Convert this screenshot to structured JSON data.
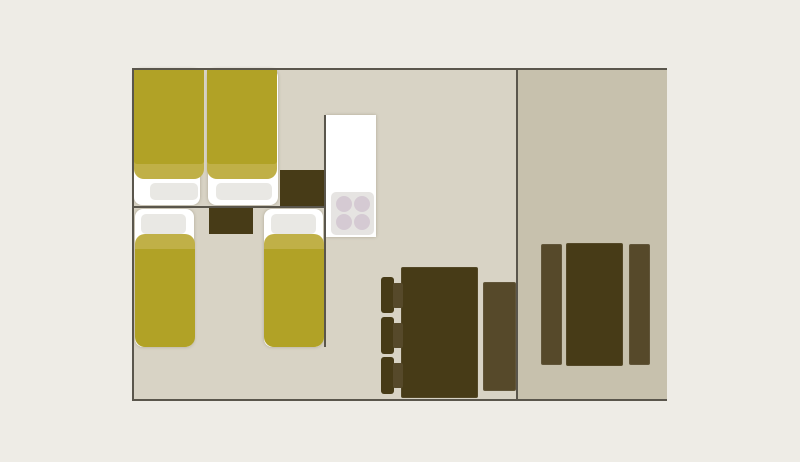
{
  "canvas": {
    "width": 800,
    "height": 462,
    "background": "#eeece6"
  },
  "palette": {
    "floor_left": "#d8d3c5",
    "floor_right": "#c7c1ad",
    "wall": "#5a564c",
    "duvet": "#b1a226",
    "duvet_band": "#c0b047",
    "mattress": "#ffffff",
    "pillow": "#e9e8e4",
    "wood_dark": "#473b17",
    "wood_mid": "#56492a",
    "counter": "#ffffff",
    "stove": "#e6e4e2",
    "burner": "#d5cad3"
  },
  "floorplan": {
    "description": "caravan-floor-plan",
    "rooms": [
      {
        "name": "left-section",
        "contains": [
          "double-bedroom",
          "twin-bedroom",
          "kitchen",
          "dining-area"
        ]
      },
      {
        "name": "right-section",
        "contains": [
          "terrace-dining"
        ]
      }
    ],
    "shapes": [
      {
        "name": "left-room-floor",
        "type": "rect",
        "x": 133,
        "y": 69,
        "w": 384,
        "h": 332,
        "fill": "floor_left"
      },
      {
        "name": "right-room-floor",
        "type": "rect",
        "x": 517,
        "y": 69,
        "w": 150,
        "h": 332,
        "fill": "floor_right"
      },
      {
        "name": "double-bed-mattress-left",
        "type": "rect",
        "x": 134,
        "y": 69,
        "w": 66,
        "h": 136,
        "fill": "mattress",
        "radius": "8px",
        "fx": "shadow"
      },
      {
        "name": "double-bed-mattress-right",
        "type": "rect",
        "x": 208,
        "y": 69,
        "w": 70,
        "h": 136,
        "fill": "mattress",
        "radius": "8px",
        "fx": "shadow"
      },
      {
        "name": "double-bed-pillow-left",
        "type": "rect",
        "x": 150,
        "y": 183,
        "w": 48,
        "h": 17,
        "fill": "pillow",
        "radius": "5px"
      },
      {
        "name": "double-bed-pillow-right",
        "type": "rect",
        "x": 216,
        "y": 183,
        "w": 56,
        "h": 17,
        "fill": "pillow",
        "radius": "5px"
      },
      {
        "name": "double-bed-duvet-band-left",
        "type": "rect",
        "x": 134,
        "y": 69,
        "w": 70,
        "h": 110,
        "fill": "duvet_band",
        "radius": "2px 2px 10px 10px"
      },
      {
        "name": "double-bed-duvet-band-right",
        "type": "rect",
        "x": 207,
        "y": 69,
        "w": 70,
        "h": 110,
        "fill": "duvet_band",
        "radius": "2px 2px 10px 10px"
      },
      {
        "name": "double-bed-duvet-left",
        "type": "rect",
        "x": 134,
        "y": 69,
        "w": 70,
        "h": 95,
        "fill": "duvet",
        "radius": "2px 2px 3px 3px"
      },
      {
        "name": "double-bed-duvet-right",
        "type": "rect",
        "x": 207,
        "y": 69,
        "w": 70,
        "h": 95,
        "fill": "duvet",
        "radius": "2px 2px 3px 3px"
      },
      {
        "name": "wardrobe",
        "type": "rect",
        "x": 280,
        "y": 170,
        "w": 45,
        "h": 37,
        "fill": "wood_dark"
      },
      {
        "name": "twin-nightstand",
        "type": "rect",
        "x": 209,
        "y": 208,
        "w": 44,
        "h": 26,
        "fill": "wood_dark"
      },
      {
        "name": "twin-bed-left-mattress",
        "type": "rect",
        "x": 135,
        "y": 209,
        "w": 59,
        "h": 138,
        "fill": "mattress",
        "radius": "8px",
        "fx": "shadow"
      },
      {
        "name": "twin-bed-left-pillow",
        "type": "rect",
        "x": 141,
        "y": 214,
        "w": 45,
        "h": 20,
        "fill": "pillow",
        "radius": "5px"
      },
      {
        "name": "twin-bed-left-duvet-band",
        "type": "rect",
        "x": 135,
        "y": 234,
        "w": 60,
        "h": 30,
        "fill": "duvet_band",
        "radius": "10px 10px 0 0"
      },
      {
        "name": "twin-bed-left-duvet",
        "type": "rect",
        "x": 135,
        "y": 249,
        "w": 60,
        "h": 98,
        "fill": "duvet",
        "radius": "0 0 10px 10px"
      },
      {
        "name": "twin-bed-right-mattress",
        "type": "rect",
        "x": 264,
        "y": 209,
        "w": 59,
        "h": 138,
        "fill": "mattress",
        "radius": "8px",
        "fx": "shadow"
      },
      {
        "name": "twin-bed-right-pillow",
        "type": "rect",
        "x": 271,
        "y": 214,
        "w": 45,
        "h": 20,
        "fill": "pillow",
        "radius": "5px"
      },
      {
        "name": "twin-bed-right-duvet-band",
        "type": "rect",
        "x": 264,
        "y": 234,
        "w": 60,
        "h": 30,
        "fill": "duvet_band",
        "radius": "10px 10px 0 0"
      },
      {
        "name": "twin-bed-right-duvet",
        "type": "rect",
        "x": 264,
        "y": 249,
        "w": 60,
        "h": 98,
        "fill": "duvet",
        "radius": "0 0 10px 10px"
      },
      {
        "name": "kitchen-counter",
        "type": "rect",
        "x": 326,
        "y": 115,
        "w": 50,
        "h": 122,
        "fill": "counter",
        "fx": "shadow"
      },
      {
        "name": "stove",
        "type": "rect",
        "x": 331,
        "y": 192,
        "w": 43,
        "h": 43,
        "fill": "stove",
        "radius": "5px"
      },
      {
        "name": "stove-burner-1",
        "type": "circle",
        "x": 336,
        "y": 196,
        "w": 16,
        "h": 16,
        "fill": "burner"
      },
      {
        "name": "stove-burner-2",
        "type": "circle",
        "x": 354,
        "y": 196,
        "w": 16,
        "h": 16,
        "fill": "burner"
      },
      {
        "name": "stove-burner-3",
        "type": "circle",
        "x": 336,
        "y": 214,
        "w": 16,
        "h": 16,
        "fill": "burner"
      },
      {
        "name": "stove-burner-4",
        "type": "circle",
        "x": 354,
        "y": 214,
        "w": 16,
        "h": 16,
        "fill": "burner"
      },
      {
        "name": "dining-table",
        "type": "rect",
        "x": 401,
        "y": 267,
        "w": 77,
        "h": 131,
        "fill": "wood_dark",
        "radius": "2px",
        "fx": "edge"
      },
      {
        "name": "dining-chair-1-back",
        "type": "rect",
        "x": 381,
        "y": 277,
        "w": 13,
        "h": 36,
        "fill": "wood_dark",
        "radius": "3px"
      },
      {
        "name": "dining-chair-1-seat",
        "type": "rect",
        "x": 393,
        "y": 283,
        "w": 10,
        "h": 25,
        "fill": "wood_mid",
        "radius": "2px"
      },
      {
        "name": "dining-chair-2-back",
        "type": "rect",
        "x": 381,
        "y": 317,
        "w": 13,
        "h": 37,
        "fill": "wood_dark",
        "radius": "3px"
      },
      {
        "name": "dining-chair-2-seat",
        "type": "rect",
        "x": 393,
        "y": 323,
        "w": 10,
        "h": 25,
        "fill": "wood_mid",
        "radius": "2px"
      },
      {
        "name": "dining-chair-3-back",
        "type": "rect",
        "x": 381,
        "y": 357,
        "w": 13,
        "h": 37,
        "fill": "wood_dark",
        "radius": "3px"
      },
      {
        "name": "dining-chair-3-seat",
        "type": "rect",
        "x": 393,
        "y": 363,
        "w": 10,
        "h": 25,
        "fill": "wood_mid",
        "radius": "2px"
      },
      {
        "name": "dining-bench",
        "type": "rect",
        "x": 483,
        "y": 282,
        "w": 33,
        "h": 109,
        "fill": "wood_mid",
        "radius": "2px",
        "fx": "edge"
      },
      {
        "name": "terrace-bench-left",
        "type": "rect",
        "x": 541,
        "y": 244,
        "w": 21,
        "h": 121,
        "fill": "wood_mid",
        "radius": "2px",
        "fx": "edge"
      },
      {
        "name": "terrace-table",
        "type": "rect",
        "x": 566,
        "y": 243,
        "w": 57,
        "h": 123,
        "fill": "wood_dark",
        "radius": "2px",
        "fx": "edge"
      },
      {
        "name": "terrace-bench-right",
        "type": "rect",
        "x": 629,
        "y": 244,
        "w": 21,
        "h": 121,
        "fill": "wood_mid",
        "radius": "2px",
        "fx": "edge"
      },
      {
        "name": "wall-top",
        "type": "rect",
        "x": 133,
        "y": 68,
        "w": 534,
        "h": 2,
        "fill": "wall"
      },
      {
        "name": "wall-bottom",
        "type": "rect",
        "x": 133,
        "y": 399,
        "w": 534,
        "h": 2,
        "fill": "wall"
      },
      {
        "name": "wall-left",
        "type": "rect",
        "x": 132,
        "y": 68,
        "w": 2,
        "h": 333,
        "fill": "wall"
      },
      {
        "name": "wall-center-divider",
        "type": "rect",
        "x": 516,
        "y": 68,
        "w": 2,
        "h": 333,
        "fill": "wall"
      },
      {
        "name": "wall-bedroom-divider",
        "type": "rect",
        "x": 133,
        "y": 206,
        "w": 193,
        "h": 2,
        "fill": "wall"
      },
      {
        "name": "wall-kitchen",
        "type": "rect",
        "x": 324,
        "y": 115,
        "w": 2,
        "h": 232,
        "fill": "wall"
      }
    ]
  }
}
